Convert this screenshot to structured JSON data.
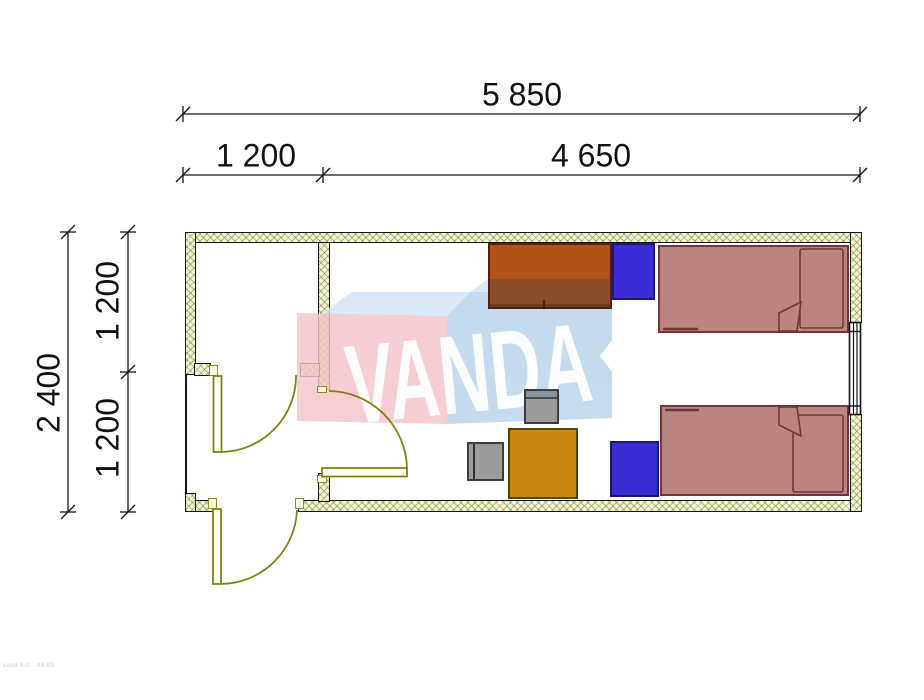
{
  "drawing": {
    "type": "floor-plan",
    "dimensions": {
      "total_width": "5 850",
      "entry_width": "1 200",
      "room_width": "4 650",
      "total_depth": "2 400",
      "depth_upper": "1 200",
      "depth_lower": "1 200"
    },
    "watermark": {
      "text": "VANDA",
      "pink": "#f5c3ca",
      "blue": "#b9d3ea",
      "top_face": "#d3e6f4"
    },
    "footer_note": "vand 6.0 - 03 03",
    "colors": {
      "wall_fill": "#f2f4da",
      "wall_hatch": "#7d871e",
      "wall_line": "#161616",
      "door": "#8f8f1d",
      "bed_fill": "#bc8383",
      "bed_border": "#6f3738",
      "wardrobe_top": "#b5521c",
      "wardrobe_bottom": "#8d4c29",
      "nightstand": "#3b2cd5",
      "desk": "#c8860b",
      "chair": "#9c9c9c"
    },
    "furniture": [
      {
        "name": "wardrobe"
      },
      {
        "name": "nightstand-top"
      },
      {
        "name": "bed-top"
      },
      {
        "name": "bed-bottom"
      },
      {
        "name": "nightstand-bottom"
      },
      {
        "name": "desk"
      },
      {
        "name": "chair-back"
      },
      {
        "name": "chair-side"
      }
    ]
  }
}
